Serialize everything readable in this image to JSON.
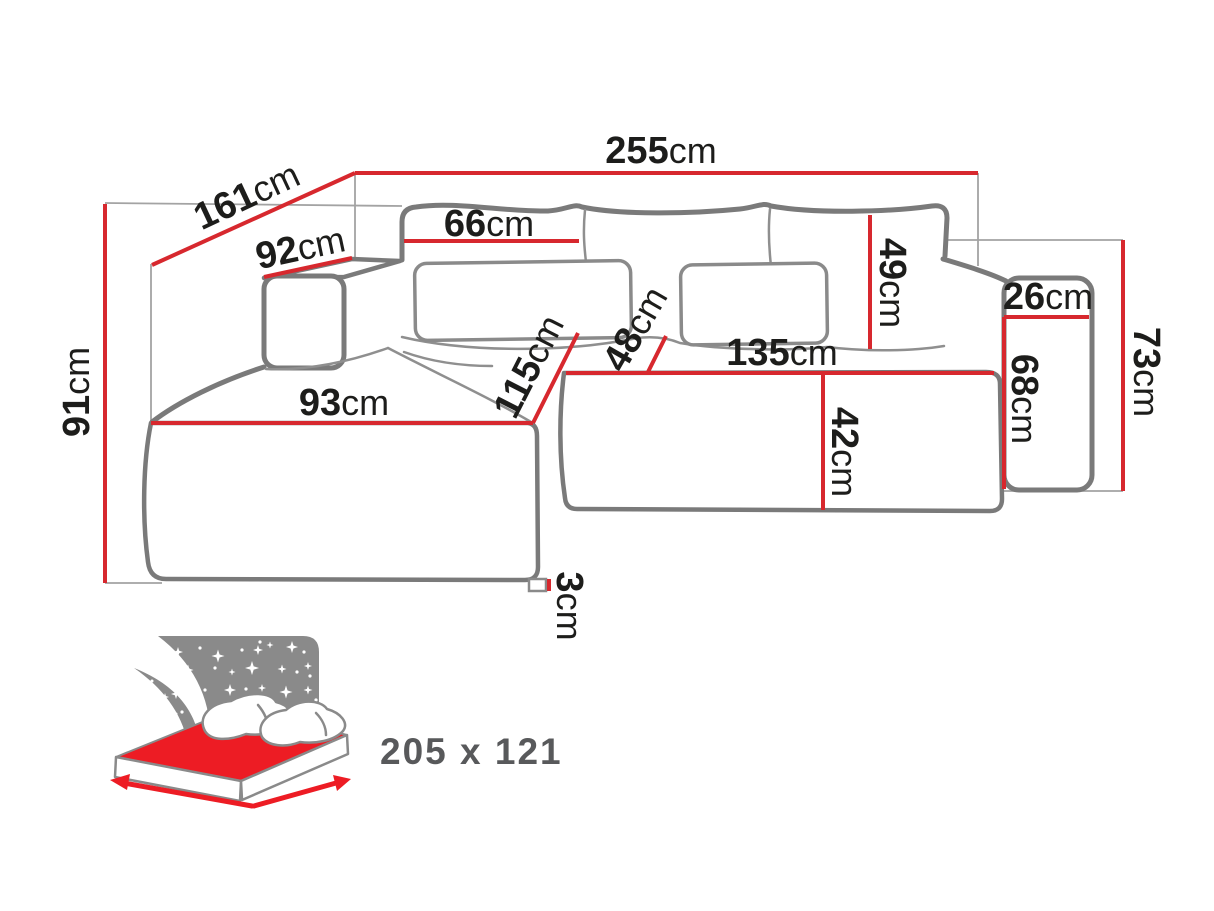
{
  "dims": {
    "total_width": {
      "value": "255",
      "unit": "cm"
    },
    "side_depth": {
      "value": "161",
      "unit": "cm"
    },
    "left_armrest_length": {
      "value": "92",
      "unit": "cm"
    },
    "back_cushion_width": {
      "value": "66",
      "unit": "cm"
    },
    "back_cushion_height": {
      "value": "49",
      "unit": "cm"
    },
    "right_armrest_width": {
      "value": "26",
      "unit": "cm"
    },
    "right_armrest_height": {
      "value": "68",
      "unit": "cm"
    },
    "right_side_height": {
      "value": "73",
      "unit": "cm"
    },
    "overall_height": {
      "value": "91",
      "unit": "cm"
    },
    "chaise_width": {
      "value": "93",
      "unit": "cm"
    },
    "chaise_depth": {
      "value": "115",
      "unit": "cm"
    },
    "seat_depth_small": {
      "value": "48",
      "unit": "cm"
    },
    "seat_width": {
      "value": "135",
      "unit": "cm"
    },
    "seat_front_height": {
      "value": "42",
      "unit": "cm"
    },
    "leg_height": {
      "value": "3",
      "unit": "cm"
    }
  },
  "sleeping_area": {
    "size": "205 x 121"
  },
  "colors": {
    "dimension_red": "#d7282e",
    "outline_grey": "#7a7a7a",
    "helper_grey": "#a3a3a3",
    "label_black": "#1d1d1b",
    "icon_panel_grey": "#8a8a8a",
    "icon_mattress_red": "#ed1c24",
    "icon_text_grey": "#58595b",
    "background": "#ffffff"
  }
}
